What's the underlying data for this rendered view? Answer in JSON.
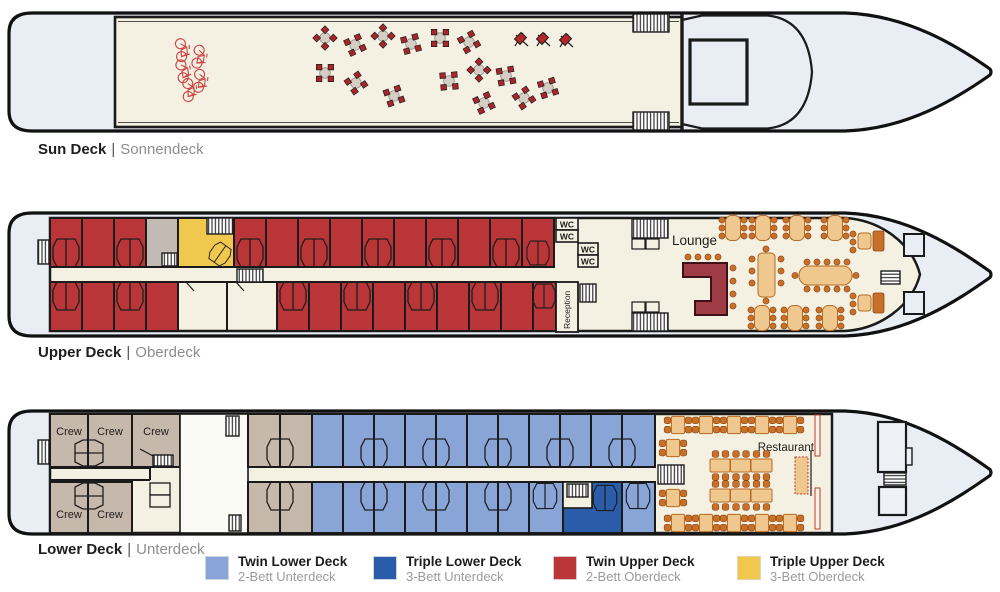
{
  "separator": "|",
  "colors": {
    "twin_lower_deck": "#89a4d7",
    "triple_lower_deck": "#2b5ca9",
    "twin_upper_deck": "#b93538",
    "triple_upper_deck": "#f0c84e",
    "crew_cabin": "#c6b8ab",
    "deck_floor": "#f4f1e2",
    "hull": "#e9edf4",
    "bar_counter": "#9e3b45",
    "chair": "#c8702a",
    "table": "#eec88f"
  },
  "decks": {
    "sun": {
      "name": "Sun Deck",
      "name_de": "Sonnendeck"
    },
    "upper": {
      "name": "Upper Deck",
      "name_de": "Oberdeck",
      "lounge": "Lounge",
      "reception": "Reception",
      "wc": "WC"
    },
    "lower": {
      "name": "Lower Deck",
      "name_de": "Unterdeck",
      "restaurant": "Restaurant",
      "crew": "Crew"
    }
  },
  "legend": [
    {
      "label": "Twin Lower Deck",
      "sublabel": "2-Bett Unterdeck",
      "color": "#89a4d7"
    },
    {
      "label": "Triple Lower Deck",
      "sublabel": "3-Bett Unterdeck",
      "color": "#2b5ca9"
    },
    {
      "label": "Twin Upper Deck",
      "sublabel": "2-Bett Oberdeck",
      "color": "#b93538"
    },
    {
      "label": "Triple Upper Deck",
      "sublabel": "3-Bett Oberdeck",
      "color": "#f0c84e"
    }
  ]
}
